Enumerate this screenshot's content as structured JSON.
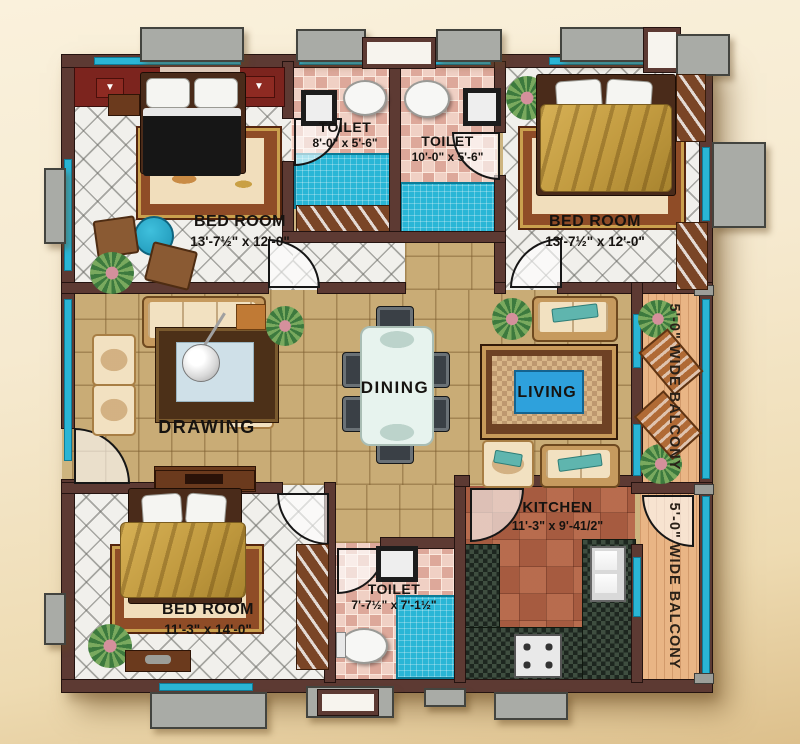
{
  "title": "apartment-floor-plan",
  "colors": {
    "wall": "#5d3a33",
    "window_glass": "#2ab5d5",
    "sunshade": "#a9aba6",
    "shower_floor": "#29b6d6",
    "kitchen_counter": "#2c3a2f",
    "blanket_gold": "#c19a3f",
    "background": "#f6ead0"
  },
  "rooms": {
    "bedroom_top_left": {
      "label": "BED ROOM",
      "dims": "13'-7½\" x 12'-0\""
    },
    "toilet_top_left": {
      "label": "TOILET",
      "dims": "8'-0\" x 5'-6\""
    },
    "toilet_top_center": {
      "label": "TOILET",
      "dims": "10'-0\" x 5'-6\""
    },
    "bedroom_top_right": {
      "label": "BED ROOM",
      "dims": "13'-7½\" x 12'-0\""
    },
    "drawing_room": {
      "label": "DRAWING"
    },
    "dining_room": {
      "label": "DINING"
    },
    "living_room": {
      "label": "LIVING"
    },
    "kitchen": {
      "label": "KITCHEN",
      "dims": "11'-3\" x 9'-41/2\""
    },
    "bedroom_bottom_left": {
      "label": "BED ROOM",
      "dims": "11'-3\" x 14'-0\""
    },
    "toilet_bottom": {
      "label": "TOILET",
      "dims": "7'-7½\" x 7'-1½\""
    },
    "balcony_top_right": {
      "label": "5'-0\" WIDE BALCONY"
    },
    "balcony_bottom_right": {
      "label": "5'-0\" WIDE BALCONY"
    }
  },
  "icons": {
    "emblem": "▼"
  }
}
